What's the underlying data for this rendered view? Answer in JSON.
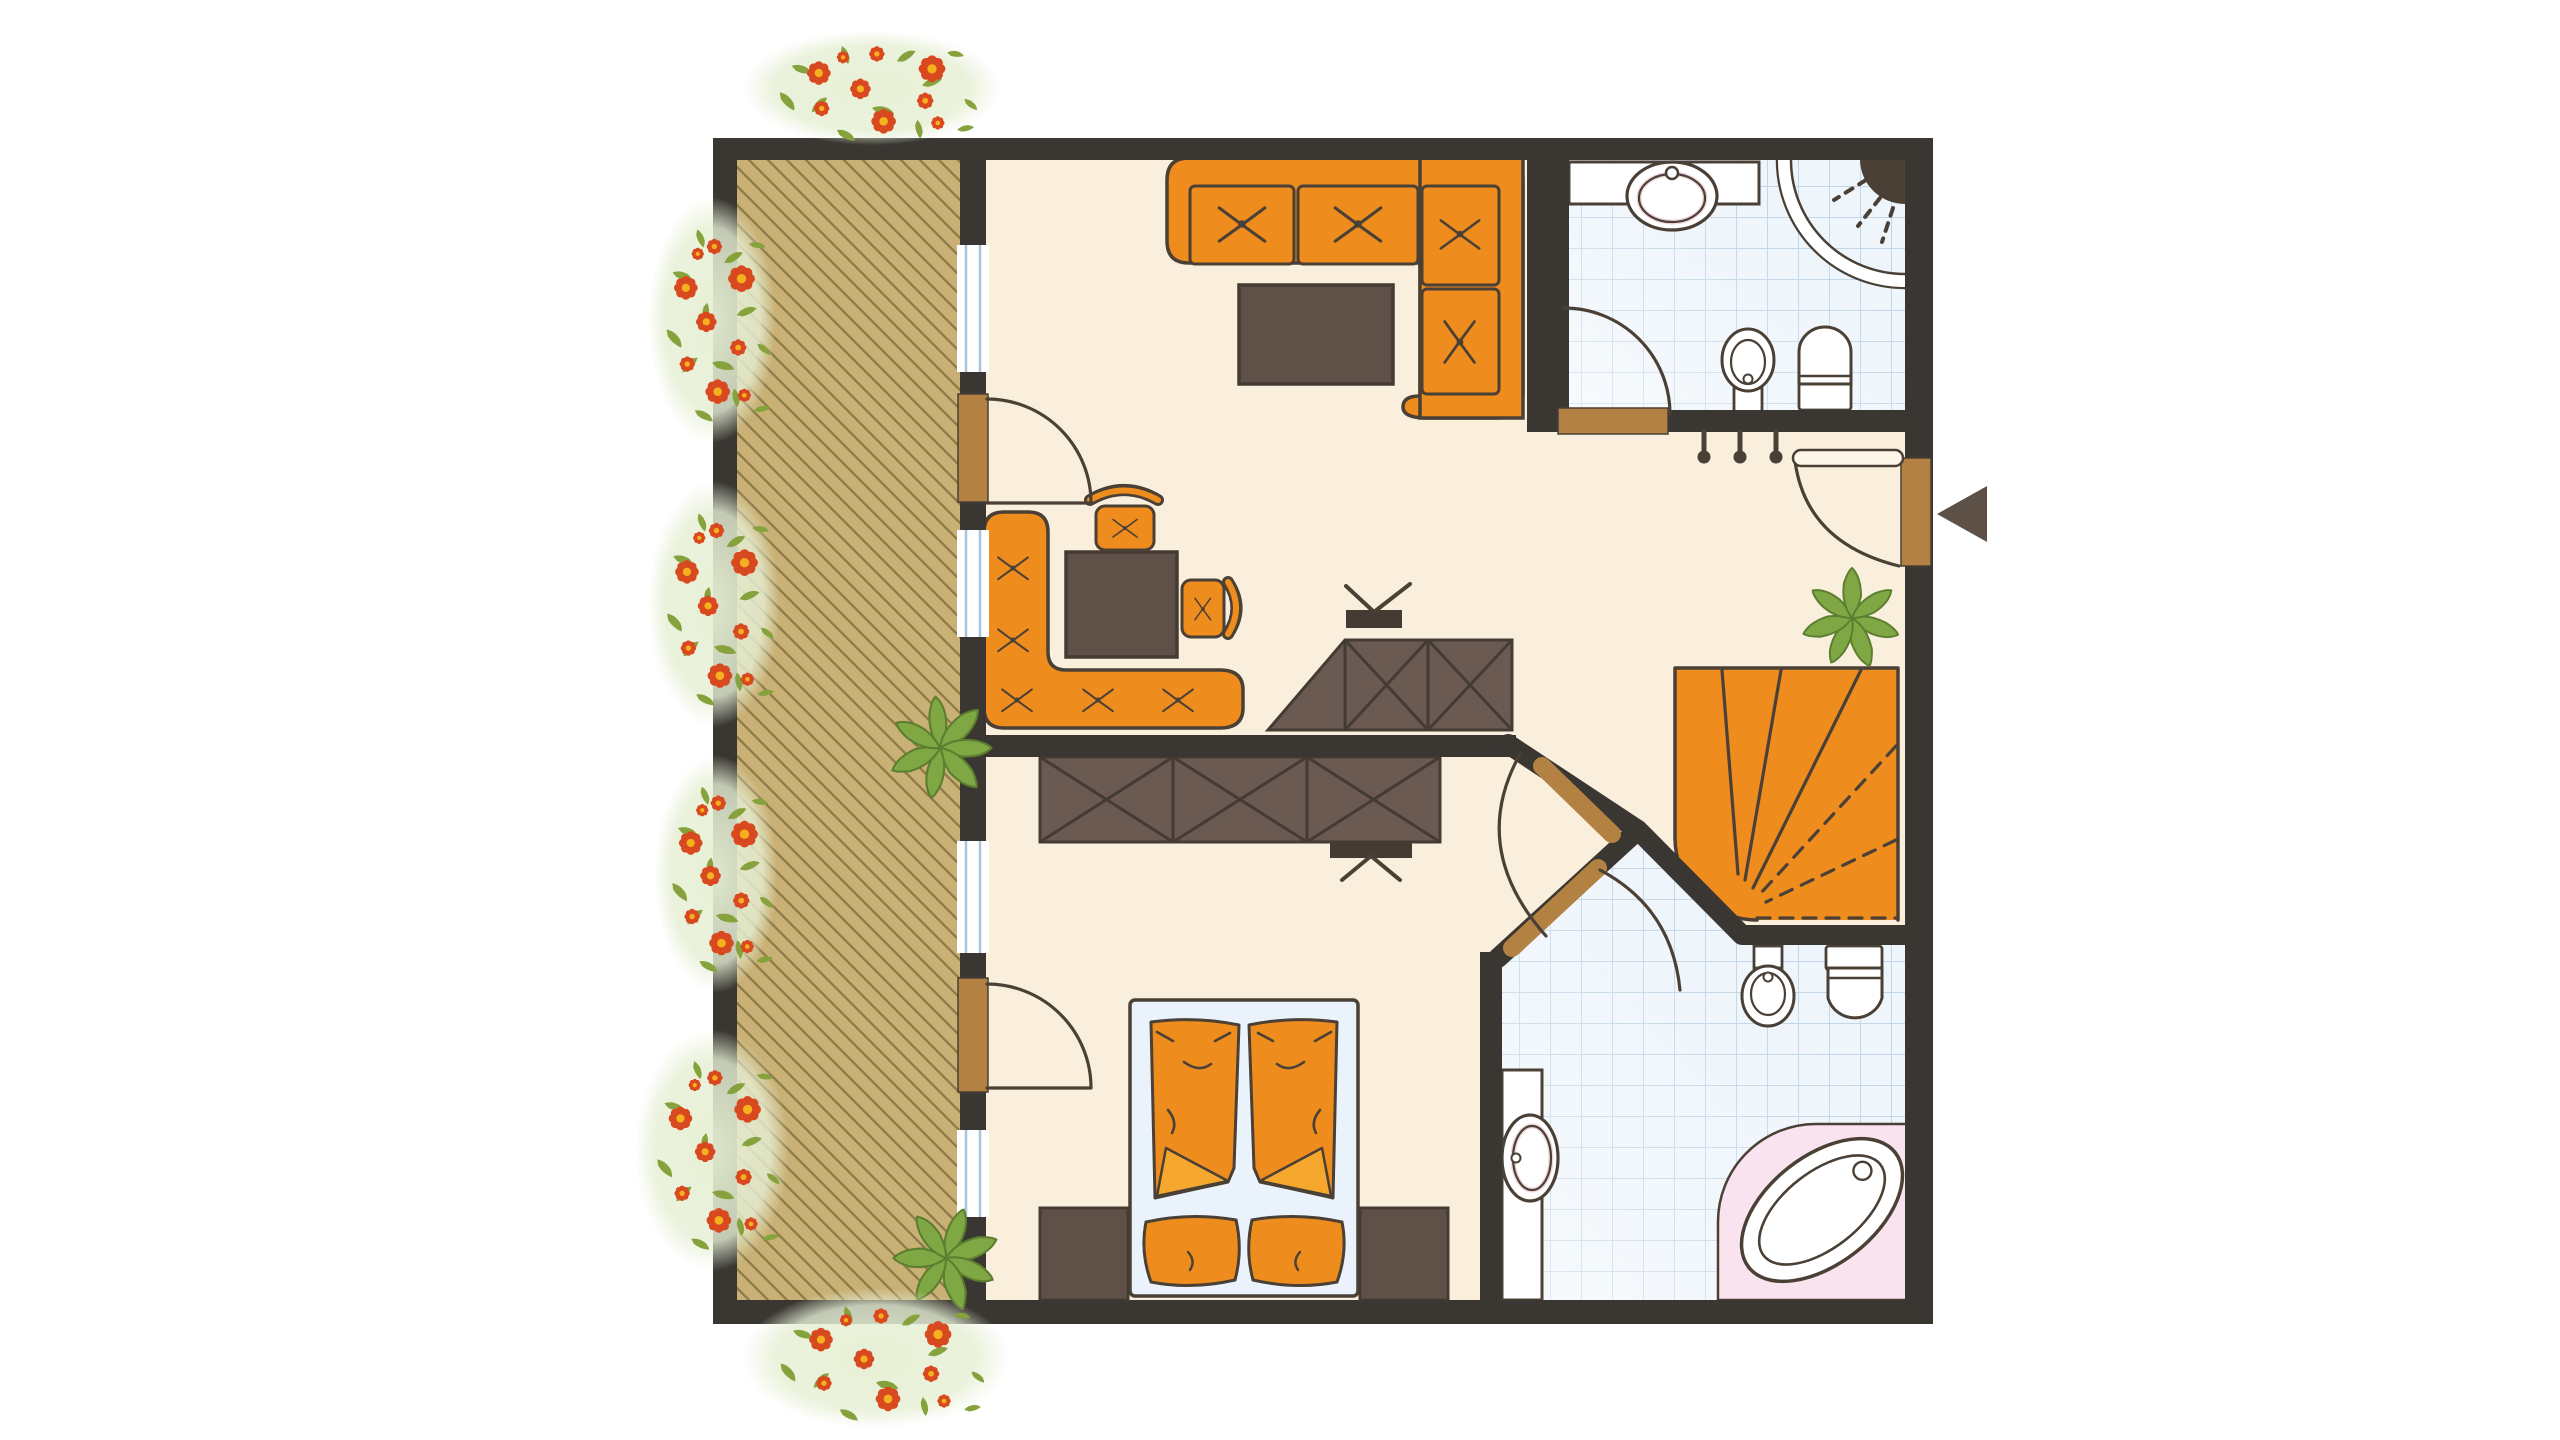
{
  "title": "Apartment floor plan (top view)",
  "palette": {
    "wall": "#3a3733",
    "outline": "#4a4035",
    "floorCream": "#faefdc",
    "deck": "#c9b074",
    "deckStripe": "#8d7b49",
    "orange": "#ee8c1e",
    "orangeLight": "#f5a72e",
    "furnDark": "#5f5148",
    "cabinet": "#6a5a52",
    "cabLine": "#443b33",
    "doorBrown": "#b3814200",
    "doorWood": "#b38142",
    "tileBg": "#eef5fb",
    "tileLine": "#c2d6e7",
    "sheet": "#eaf3fb",
    "pink": "#f8e3ef",
    "plantGreen": "#7fa845",
    "plantDark": "#5c7e2e",
    "leafGreen": "#86a23c",
    "flowerRed": "#d9491f",
    "flowerCore": "#f5b01d",
    "gardenBg": "#e6efd4",
    "arrow": "#5d5047",
    "basinRing": "#efd7dc"
  },
  "garden": {
    "clusters": [
      {
        "cx": 872,
        "cy": 88,
        "rx": 118,
        "ry": 52
      },
      {
        "cx": 712,
        "cy": 320,
        "rx": 58,
        "ry": 112
      },
      {
        "cx": 714,
        "cy": 604,
        "rx": 60,
        "ry": 112
      },
      {
        "cx": 716,
        "cy": 874,
        "rx": 56,
        "ry": 108
      },
      {
        "cx": 712,
        "cy": 1150,
        "rx": 70,
        "ry": 110
      },
      {
        "cx": 876,
        "cy": 1358,
        "rx": 122,
        "ry": 64
      }
    ]
  },
  "plants": [
    {
      "x": 940,
      "y": 748,
      "s": 1.05,
      "r": -15
    },
    {
      "x": 946,
      "y": 1258,
      "s": 1.05,
      "r": 10
    },
    {
      "x": 1852,
      "y": 618,
      "s": 1.0,
      "r": 100
    }
  ],
  "coat_hooks": {
    "count": 3
  },
  "entrance": {
    "arrow_direction": "left"
  }
}
